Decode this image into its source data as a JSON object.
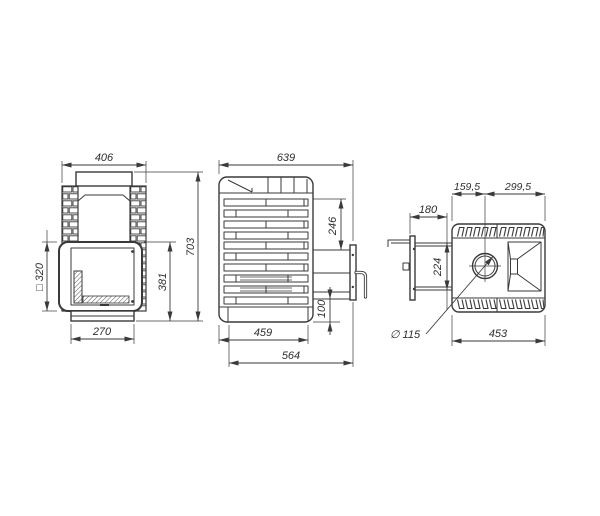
{
  "drawing": {
    "front": {
      "width": "406",
      "height": "703",
      "opening": "□ 320",
      "door_height": "381",
      "base_width": "270"
    },
    "side": {
      "depth": "639",
      "top_to_door": "246",
      "door_to_floor": "100",
      "base_depth": "459",
      "full_depth": "564"
    },
    "top": {
      "back_to_chimney": "159,5",
      "chimney_to_front": "299,5",
      "tunnel_length": "180",
      "tunnel_width": "224",
      "chimney_diameter": "∅ 115",
      "width": "453"
    }
  },
  "colors": {
    "line": "#3a3a3a",
    "background": "#ffffff"
  }
}
